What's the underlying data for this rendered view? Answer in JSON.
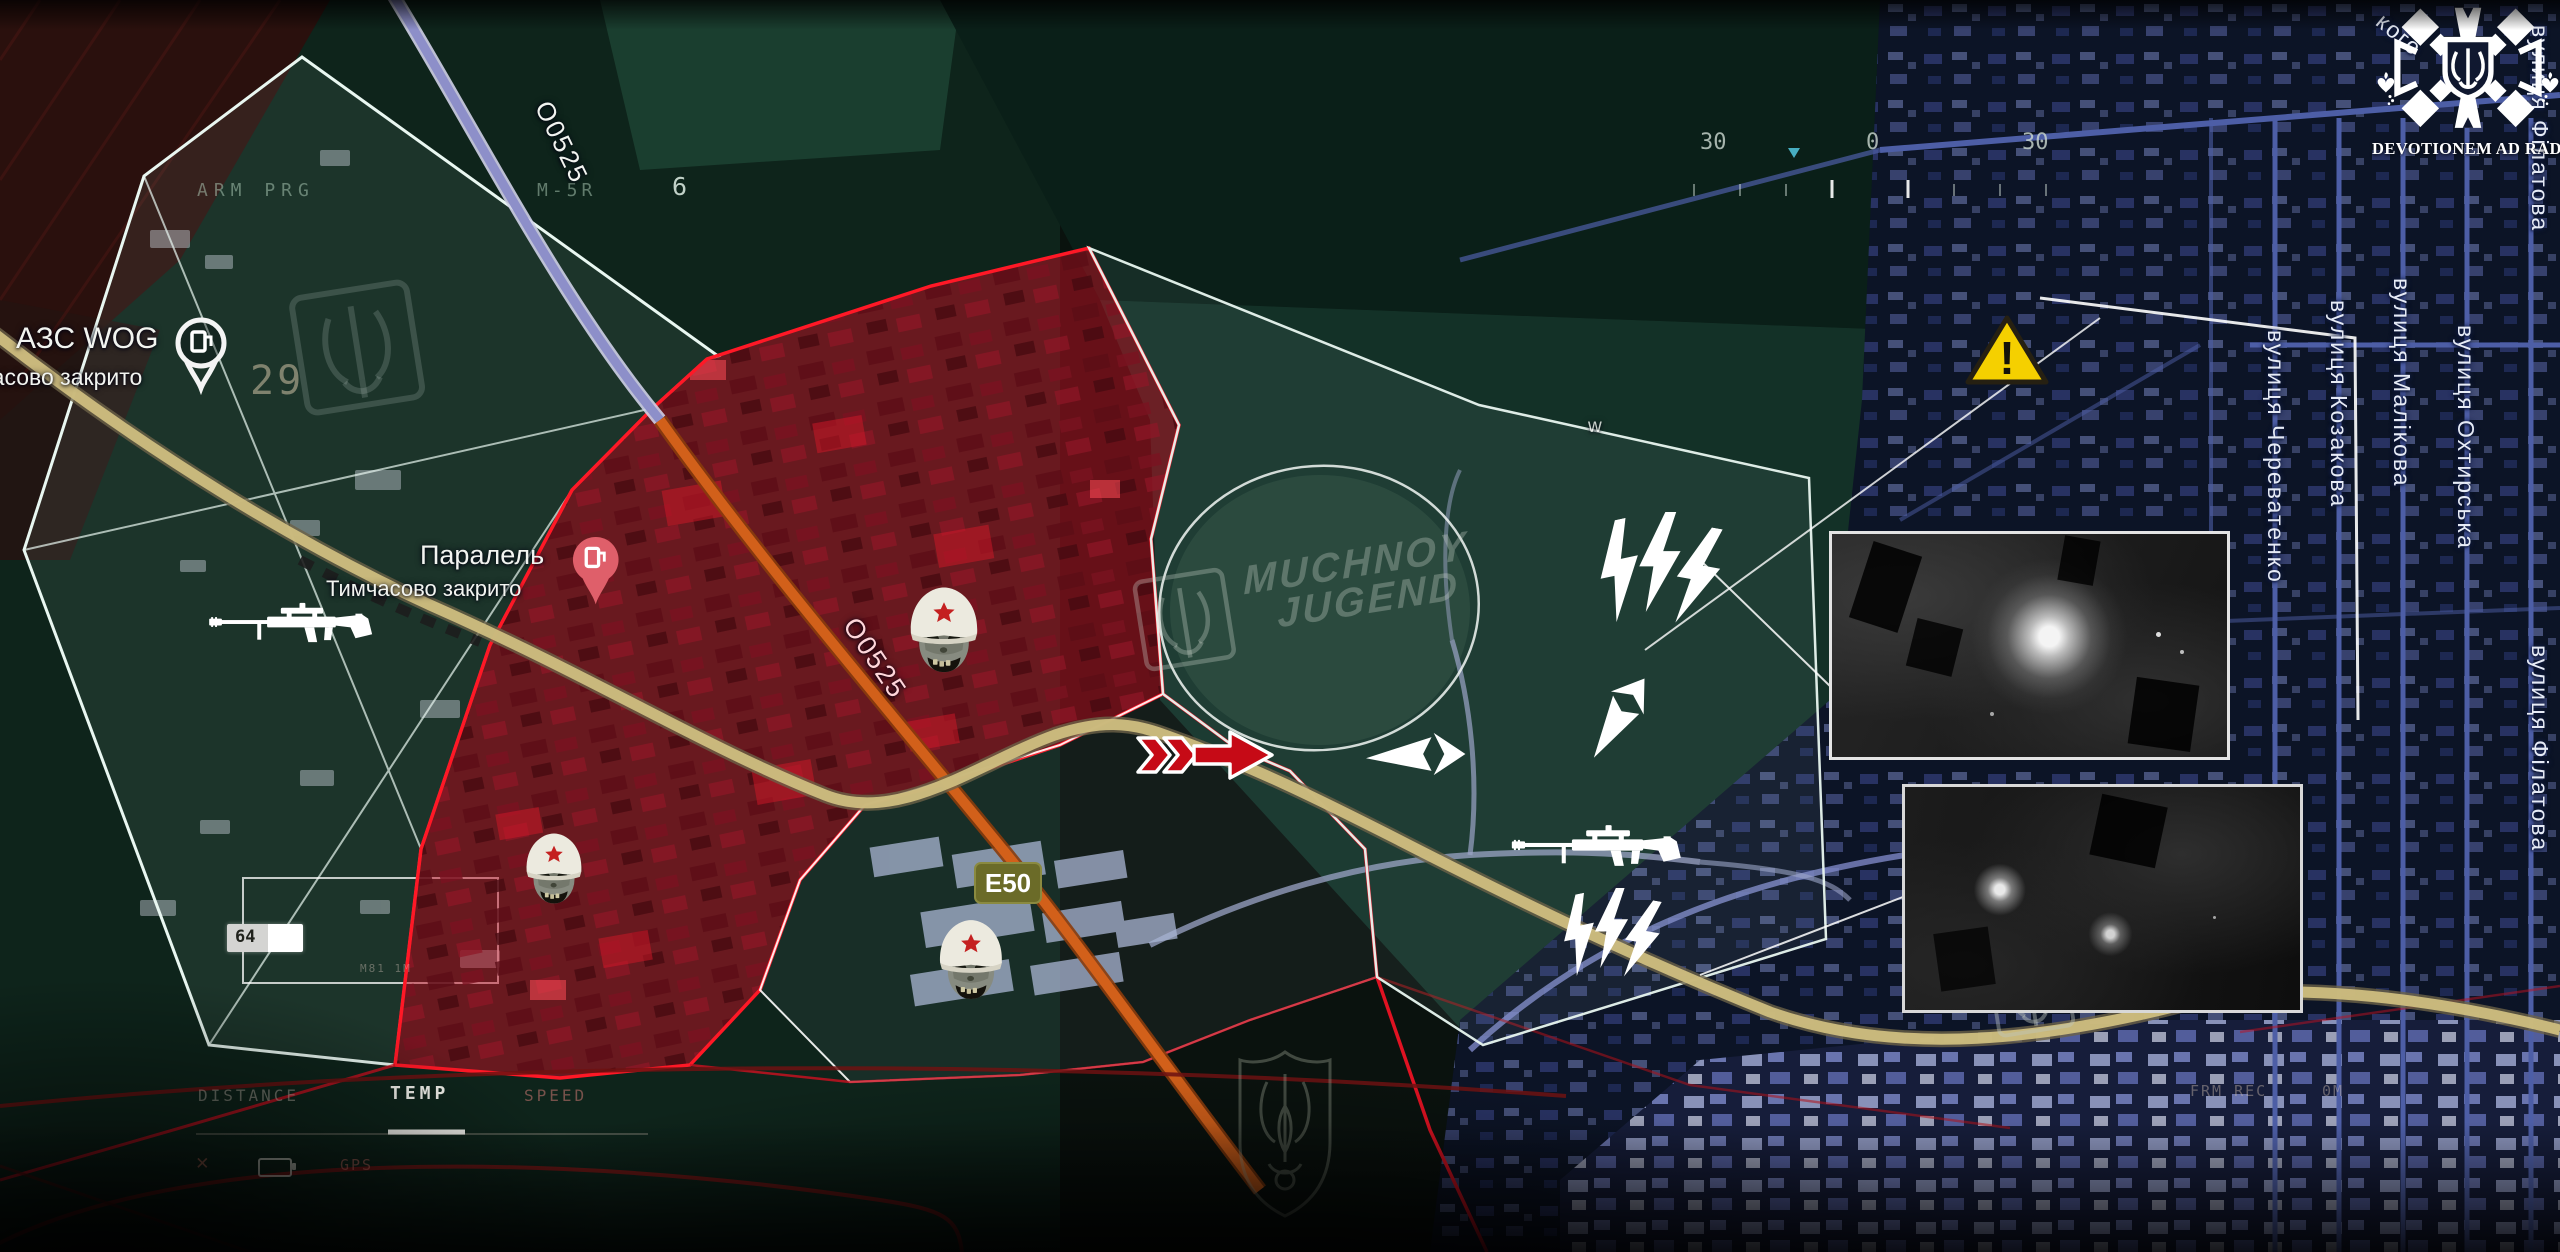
{
  "colors": {
    "red_zone": "#e81a2c",
    "frontline_red": "#d01020",
    "recon_white": "#e9f7f1",
    "city_blue": "#4d5ea6",
    "road_yellow": "#cfbe7f",
    "road_orange": "#d2601a",
    "warning_yellow": "#f5d000",
    "helmet_star_red": "#c42020"
  },
  "hud": {
    "prefix": "ARM PRG",
    "model": "M-5R",
    "channel": "6",
    "altitude": "29",
    "compass_left": "30",
    "compass_center": "0",
    "compass_right": "30",
    "distance": "DISTANCE",
    "temp": "TEMP",
    "speed": "SPEED",
    "gps": "GPS",
    "box_value": "64",
    "frm": "FRM REC",
    "zero_m": "0M",
    "m81": "M81 1M",
    "close_x": "✕"
  },
  "labels": {
    "gas_station_name": "АЗС WOG",
    "gas_station_status": "Тимчасово закрито",
    "parallel_name": "Паралель",
    "parallel_status": "Тимчасово закрито",
    "road_o0525_a": "О0525",
    "road_o0525_b": "О0525",
    "road_e50": "Е50",
    "map_letter_w": "w"
  },
  "streets": [
    {
      "name": "вулиця Череватенко"
    },
    {
      "name": "вулиця Козакова"
    },
    {
      "name": "вулиця Малікова"
    },
    {
      "name": "вулиця Охтирська"
    },
    {
      "name": "вулиця Філатова"
    },
    {
      "name": "вулиця Філатова"
    },
    {
      "name": "кого"
    }
  ],
  "logo": {
    "motto": "DEVOTIONEM AD RADICES"
  },
  "watermark": {
    "line1": "MUCHNOY",
    "line2": "JUGEND"
  },
  "warning": {
    "mark": "!"
  },
  "icons": {
    "orc_head": "helmeted-orc-skull",
    "rifle": "sniper-rifle",
    "lightning": "triple-lightning-strike",
    "red_arrow": "attack-direction-arrow",
    "white_arrow": "counterattack-arrow",
    "gas_pin": "fuel-station-pin",
    "warning_triangle": "hazard-warning"
  }
}
